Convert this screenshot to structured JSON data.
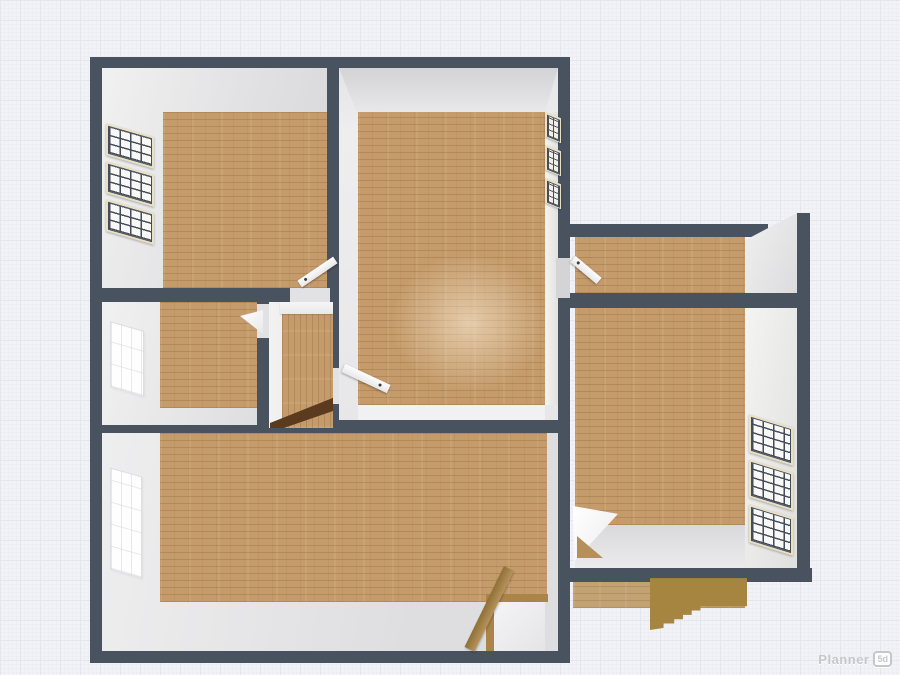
{
  "app": {
    "name": "Planner 5d",
    "logo_text": "Planner",
    "logo_badge": "5d"
  },
  "colors": {
    "wall": "#49525f",
    "floor_wood": "#c59b6b",
    "floor_wood_line": "#825c30",
    "deck_wood": "#c2a173",
    "stair_olive": "#a5853f",
    "stair_dark": "#5b3a1e",
    "beam_wood": "#ab8449",
    "window_frame": "#eae0c2",
    "pane_line": "#454d5a",
    "bg": "#f3f3f5",
    "grid_major": "#e4e6ed",
    "grid_minor": "#eceef4",
    "face_light": "#f0f0f2",
    "face_mid": "#e2e2e4",
    "face_dark": "#d4d4d6",
    "door_white": "#f8f8f8",
    "logo_gray": "#c6c7cc"
  },
  "scene": {
    "view": "3d-overhead-floorplan",
    "rooms": [
      {
        "id": "top-left-room",
        "floor": "wood",
        "windows": 3,
        "doors": 1
      },
      {
        "id": "top-middle-room",
        "floor": "wood",
        "windows": 3,
        "doors": 2
      },
      {
        "id": "mid-left-room",
        "floor": "wood",
        "windows": 1,
        "doors": 1
      },
      {
        "id": "hallway-closet",
        "floor": "wood",
        "stairs": true
      },
      {
        "id": "bottom-living-room",
        "floor": "wood",
        "windows": 1,
        "stairwell": true
      },
      {
        "id": "right-wing-top-room",
        "floor": "wood",
        "doors": 1
      },
      {
        "id": "right-wing-bottom-room",
        "floor": "wood",
        "windows": 3,
        "doors": 1
      },
      {
        "id": "entry-deck",
        "floor": "wood",
        "stairs": true
      }
    ]
  }
}
